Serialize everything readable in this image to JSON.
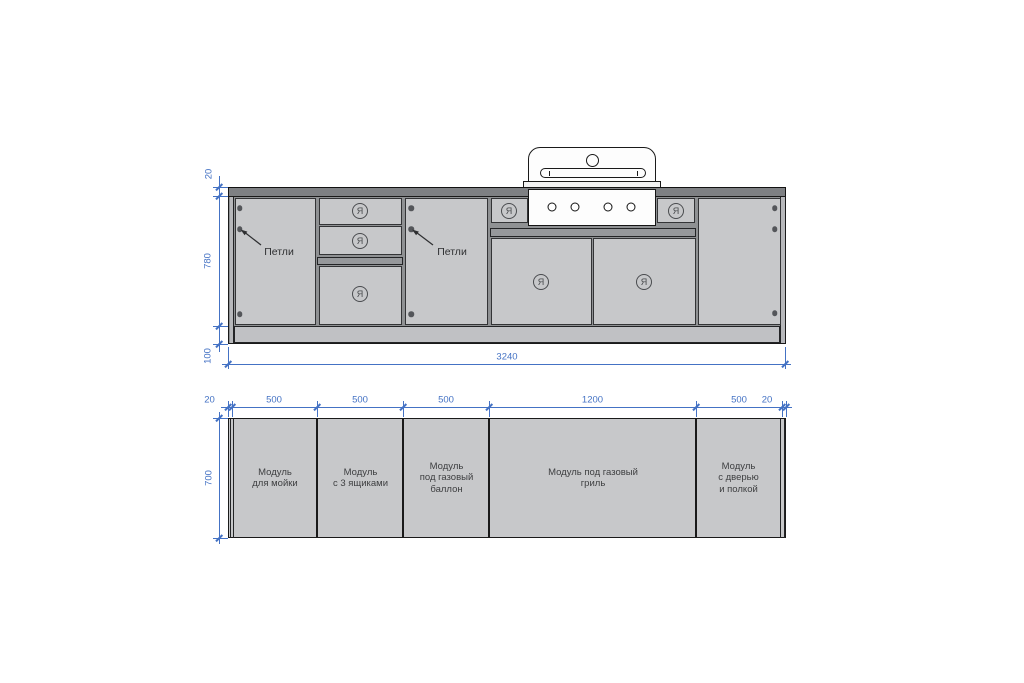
{
  "drawing": {
    "front_view": {
      "hinge_labels": [
        "Петли",
        "Петли"
      ],
      "drawer_mark": "Я",
      "dimensions": {
        "countertop_thickness": "20",
        "cabinet_height": "780",
        "plinth_height": "100",
        "total_width": "3240"
      }
    },
    "plan_view": {
      "dimensions": {
        "side_panel_left": "20",
        "module_1_width": "500",
        "module_2_width": "500",
        "module_3_width": "500",
        "module_4_width": "1200",
        "module_5_width": "500",
        "side_panel_right": "20",
        "depth": "700"
      },
      "modules": [
        {
          "lines": [
            "Модуль",
            "для мойки"
          ]
        },
        {
          "lines": [
            "Модуль",
            "с 3 ящиками"
          ]
        },
        {
          "lines": [
            "Модуль",
            "под газовый",
            "баллон"
          ]
        },
        {
          "lines": [
            "Модуль под газовый",
            "гриль"
          ]
        },
        {
          "lines": [
            "Модуль",
            "с дверью",
            "и полкой"
          ]
        }
      ]
    },
    "colors": {
      "dimension": "#4472c4",
      "panel_fill": "#c7c8ca",
      "countertop_fill": "#7e8083",
      "rail_fill": "#96989b",
      "outline": "#1a1a1a",
      "label_text": "#3e3f41"
    }
  }
}
